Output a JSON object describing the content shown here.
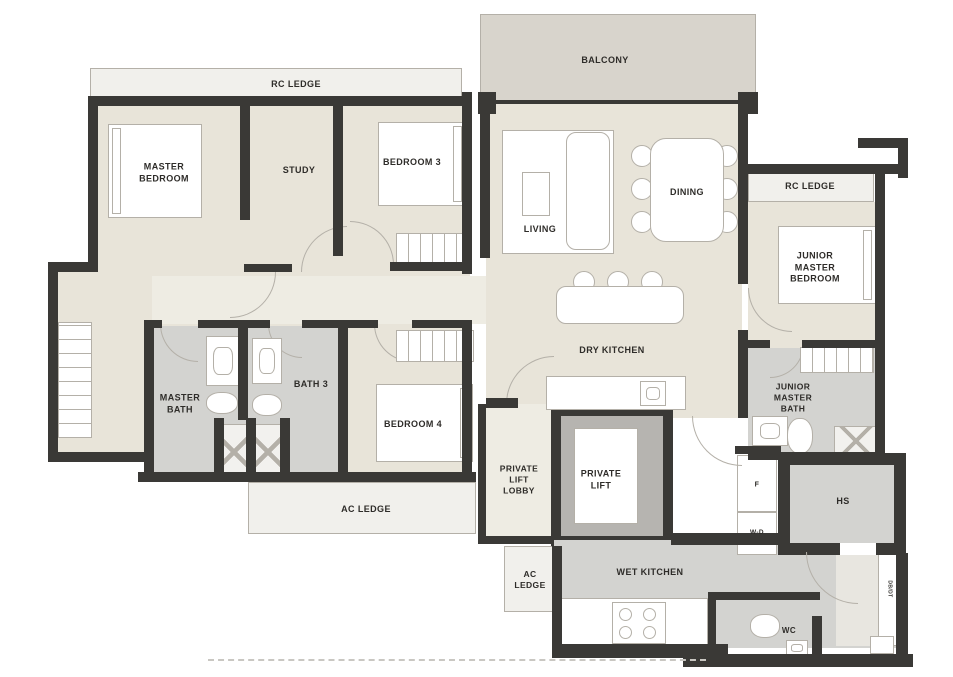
{
  "title": "Residential Unit Floor Plan",
  "colors": {
    "wall": "#3a3936",
    "beige": "#e8e4d9",
    "cream": "#eeece3",
    "grey": "#d3d3d0",
    "balcony": "#d8d4cc",
    "ledge": "#f1f0ec",
    "liftgrey": "#b6b4b0",
    "white": "#ffffff",
    "lightzone": "#e8e6e0",
    "line": "#b4b0a8",
    "text": "#2e2c29"
  },
  "labels": [
    {
      "name": "rc-ledge-top-label",
      "text": "RC LEDGE",
      "x": 296,
      "y": 85,
      "s": 9
    },
    {
      "name": "balcony-label",
      "text": "BALCONY",
      "x": 605,
      "y": 61,
      "s": 9
    },
    {
      "name": "master-bedroom-label",
      "text": "MASTER\nBEDROOM",
      "x": 164,
      "y": 173,
      "s": 9
    },
    {
      "name": "study-label",
      "text": "STUDY",
      "x": 299,
      "y": 171,
      "s": 9
    },
    {
      "name": "bedroom-3-label",
      "text": "BEDROOM 3",
      "x": 412,
      "y": 163,
      "s": 9
    },
    {
      "name": "living-label",
      "text": "LIVING",
      "x": 540,
      "y": 230,
      "s": 9
    },
    {
      "name": "dining-label",
      "text": "DINING",
      "x": 687,
      "y": 193,
      "s": 9
    },
    {
      "name": "rc-ledge-right-label",
      "text": "RC LEDGE",
      "x": 810,
      "y": 187,
      "s": 9
    },
    {
      "name": "junior-master-bedroom-label",
      "text": "JUNIOR\nMASTER\nBEDROOM",
      "x": 815,
      "y": 268,
      "s": 9
    },
    {
      "name": "dry-kitchen-label",
      "text": "DRY KITCHEN",
      "x": 612,
      "y": 351,
      "s": 9
    },
    {
      "name": "master-bath-label",
      "text": "MASTER\nBATH",
      "x": 180,
      "y": 404,
      "s": 9
    },
    {
      "name": "bath-3-label",
      "text": "BATH 3",
      "x": 311,
      "y": 385,
      "s": 9
    },
    {
      "name": "bedroom-4-label",
      "text": "BEDROOM 4",
      "x": 413,
      "y": 425,
      "s": 9
    },
    {
      "name": "ac-ledge-left-label",
      "text": "AC LEDGE",
      "x": 366,
      "y": 510,
      "s": 9
    },
    {
      "name": "private-lift-lobby-label",
      "text": "PRIVATE\nLIFT\nLOBBY",
      "x": 519,
      "y": 480,
      "s": 8.5
    },
    {
      "name": "private-lift-label",
      "text": "PRIVATE\nLIFT",
      "x": 601,
      "y": 480,
      "s": 9
    },
    {
      "name": "junior-master-bath-label",
      "text": "JUNIOR\nMASTER\nBATH",
      "x": 793,
      "y": 398,
      "s": 8.5
    },
    {
      "name": "fridge-label",
      "text": "F",
      "x": 757,
      "y": 485,
      "s": 7
    },
    {
      "name": "washer-dryer-label",
      "text": "W-D",
      "x": 757,
      "y": 533,
      "s": 6.5
    },
    {
      "name": "household-shelter-label",
      "text": "HS",
      "x": 843,
      "y": 502,
      "s": 9
    },
    {
      "name": "ac-ledge-small-label",
      "text": "AC\nLEDGE",
      "x": 530,
      "y": 580,
      "s": 8.5
    },
    {
      "name": "wet-kitchen-label",
      "text": "WET KITCHEN",
      "x": 650,
      "y": 573,
      "s": 9
    },
    {
      "name": "wc-label",
      "text": "WC",
      "x": 789,
      "y": 631,
      "s": 8
    },
    {
      "name": "db-dt-label",
      "text": "DB/DT",
      "x": 889,
      "y": 589,
      "s": 5,
      "rot": 90
    }
  ],
  "floors": [
    {
      "n": "rc-ledge-top",
      "x": 90,
      "y": 68,
      "w": 372,
      "h": 34,
      "f": "ledge",
      "br": true
    },
    {
      "n": "balcony",
      "x": 480,
      "y": 14,
      "w": 276,
      "h": 88,
      "f": "balcony",
      "br": true
    },
    {
      "n": "bedrooms-floor",
      "x": 92,
      "y": 103,
      "w": 378,
      "h": 230,
      "f": "beige"
    },
    {
      "n": "corridor",
      "x": 150,
      "y": 276,
      "w": 336,
      "h": 48,
      "f": "cream"
    },
    {
      "n": "walk-in-wardrobe-floor",
      "x": 52,
      "y": 266,
      "w": 100,
      "h": 196,
      "f": "beige"
    },
    {
      "n": "master-bath-floor",
      "x": 144,
      "y": 326,
      "w": 102,
      "h": 152,
      "f": "grey"
    },
    {
      "n": "bath-3-floor",
      "x": 246,
      "y": 326,
      "w": 98,
      "h": 152,
      "f": "grey"
    },
    {
      "n": "bedroom-4-floor",
      "x": 344,
      "y": 326,
      "w": 128,
      "h": 152,
      "f": "beige"
    },
    {
      "n": "ac-ledge-left",
      "x": 248,
      "y": 482,
      "w": 228,
      "h": 52,
      "f": "ledge",
      "br": true
    },
    {
      "n": "living-dining-floor",
      "x": 486,
      "y": 104,
      "w": 256,
      "h": 314,
      "f": "beige"
    },
    {
      "n": "rc-ledge-right",
      "x": 748,
      "y": 172,
      "w": 126,
      "h": 30,
      "f": "ledge",
      "br": true
    },
    {
      "n": "junior-master-bedroom-floor",
      "x": 748,
      "y": 202,
      "w": 127,
      "h": 146,
      "f": "beige"
    },
    {
      "n": "junior-master-bath-floor",
      "x": 748,
      "y": 348,
      "w": 127,
      "h": 110,
      "f": "grey"
    },
    {
      "n": "private-lift-lobby-floor",
      "x": 482,
      "y": 404,
      "w": 70,
      "h": 136,
      "f": "cream"
    },
    {
      "n": "private-lift-frame",
      "x": 551,
      "y": 406,
      "w": 122,
      "h": 140,
      "f": "wall"
    },
    {
      "n": "private-lift-inner",
      "x": 561,
      "y": 416,
      "w": 102,
      "h": 120,
      "f": "liftgrey"
    },
    {
      "n": "private-lift-cab",
      "x": 574,
      "y": 428,
      "w": 64,
      "h": 96,
      "f": "white",
      "br": true
    },
    {
      "n": "ac-ledge-small",
      "x": 504,
      "y": 546,
      "w": 52,
      "h": 66,
      "f": "ledge",
      "br": true
    },
    {
      "n": "wet-kitchen-floor",
      "x": 554,
      "y": 540,
      "w": 344,
      "h": 108,
      "f": "grey"
    },
    {
      "n": "entry-corridor",
      "x": 836,
      "y": 552,
      "w": 42,
      "h": 94,
      "f": "lightzone"
    },
    {
      "n": "db-dt-strip",
      "x": 878,
      "y": 548,
      "w": 20,
      "h": 98,
      "f": "white",
      "br": true
    },
    {
      "n": "fridge-box",
      "x": 737,
      "y": 455,
      "w": 40,
      "h": 57,
      "f": "white",
      "br": true
    },
    {
      "n": "washer-dryer-box",
      "x": 737,
      "y": 512,
      "w": 40,
      "h": 43,
      "f": "white",
      "br": true
    },
    {
      "n": "household-shelter-frame",
      "x": 778,
      "y": 453,
      "w": 128,
      "h": 102,
      "f": "wall"
    },
    {
      "n": "household-shelter-inner",
      "x": 790,
      "y": 465,
      "w": 104,
      "h": 78,
      "f": "grey"
    },
    {
      "n": "household-shelter-door-gap",
      "x": 840,
      "y": 543,
      "w": 36,
      "h": 12,
      "f": "white"
    },
    {
      "n": "wc-floor",
      "x": 716,
      "y": 600,
      "w": 96,
      "h": 48,
      "f": "grey"
    },
    {
      "n": "kitchen-counter",
      "x": 556,
      "y": 598,
      "w": 152,
      "h": 48,
      "f": "white",
      "br": true
    }
  ],
  "furniture": [
    {
      "n": "walkin-wardrobe",
      "k": "wardrobe-v",
      "x": 58,
      "y": 322,
      "w": 34,
      "h": 116
    },
    {
      "n": "master-bed",
      "k": "bed",
      "x": 108,
      "y": 124,
      "w": 94,
      "h": 94,
      "hb": "l"
    },
    {
      "n": "bedroom3-bed",
      "k": "bed",
      "x": 378,
      "y": 122,
      "w": 88,
      "h": 84,
      "hb": "r"
    },
    {
      "n": "bedroom3-cabinet",
      "k": "wardrobe-h",
      "x": 396,
      "y": 233,
      "w": 76,
      "h": 32
    },
    {
      "n": "bedroom4-wardrobe",
      "k": "wardrobe-h",
      "x": 396,
      "y": 330,
      "w": 78,
      "h": 32
    },
    {
      "n": "bedroom4-bed",
      "k": "bed",
      "x": 376,
      "y": 384,
      "w": 97,
      "h": 78,
      "hb": "r"
    },
    {
      "n": "junior-bed",
      "k": "bed",
      "x": 778,
      "y": 226,
      "w": 98,
      "h": 78,
      "hb": "r"
    },
    {
      "n": "junior-wardrobe",
      "k": "wardrobe-h",
      "x": 800,
      "y": 347,
      "w": 74,
      "h": 26
    },
    {
      "n": "living-rug",
      "k": "box",
      "x": 502,
      "y": 130,
      "w": 112,
      "h": 124
    },
    {
      "n": "tv-console",
      "k": "box",
      "x": 522,
      "y": 172,
      "w": 28,
      "h": 44
    },
    {
      "n": "sofa",
      "k": "round",
      "x": 566,
      "y": 132,
      "w": 44,
      "h": 118,
      "r": 10
    },
    {
      "n": "dining-chair",
      "k": "circle",
      "x": 631,
      "y": 145,
      "w": 22,
      "h": 22
    },
    {
      "n": "dining-chair",
      "k": "circle",
      "x": 631,
      "y": 178,
      "w": 22,
      "h": 22
    },
    {
      "n": "dining-chair",
      "k": "circle",
      "x": 631,
      "y": 211,
      "w": 22,
      "h": 22
    },
    {
      "n": "dining-chair",
      "k": "circle",
      "x": 716,
      "y": 145,
      "w": 22,
      "h": 22
    },
    {
      "n": "dining-chair",
      "k": "circle",
      "x": 716,
      "y": 178,
      "w": 22,
      "h": 22
    },
    {
      "n": "dining-chair",
      "k": "circle",
      "x": 716,
      "y": 211,
      "w": 22,
      "h": 22
    },
    {
      "n": "dining-table",
      "k": "round",
      "x": 650,
      "y": 138,
      "w": 74,
      "h": 104,
      "r": 16
    },
    {
      "n": "bar-stool",
      "k": "circle",
      "x": 573,
      "y": 271,
      "w": 22,
      "h": 22
    },
    {
      "n": "bar-stool",
      "k": "circle",
      "x": 607,
      "y": 271,
      "w": 22,
      "h": 22
    },
    {
      "n": "bar-stool",
      "k": "circle",
      "x": 641,
      "y": 271,
      "w": 22,
      "h": 22
    },
    {
      "n": "kitchen-island",
      "k": "round",
      "x": 556,
      "y": 286,
      "w": 128,
      "h": 38,
      "r": 10
    },
    {
      "n": "dry-kitchen-counter",
      "k": "box",
      "x": 546,
      "y": 376,
      "w": 140,
      "h": 34
    },
    {
      "n": "dry-kitchen-sink",
      "k": "sink",
      "x": 640,
      "y": 381,
      "w": 26,
      "h": 25
    },
    {
      "n": "master-bath-sink",
      "k": "sink",
      "x": 206,
      "y": 336,
      "w": 34,
      "h": 50
    },
    {
      "n": "master-bath-toilet",
      "k": "toilet",
      "x": 206,
      "y": 392,
      "w": 32,
      "h": 22
    },
    {
      "n": "master-shower",
      "k": "shower",
      "x": 220,
      "y": 424,
      "w": 28,
      "h": 56
    },
    {
      "n": "master-shower-2",
      "k": "shower",
      "x": 254,
      "y": 424,
      "w": 28,
      "h": 56
    },
    {
      "n": "bath3-sink",
      "k": "sink",
      "x": 252,
      "y": 338,
      "w": 30,
      "h": 46
    },
    {
      "n": "bath3-toilet",
      "k": "toilet",
      "x": 252,
      "y": 394,
      "w": 30,
      "h": 22
    },
    {
      "n": "junior-bath-sink",
      "k": "sink",
      "x": 752,
      "y": 416,
      "w": 36,
      "h": 30
    },
    {
      "n": "junior-bath-heater",
      "k": "toilet",
      "x": 787,
      "y": 418,
      "w": 26,
      "h": 36
    },
    {
      "n": "junior-shower",
      "k": "shower",
      "x": 834,
      "y": 426,
      "w": 44,
      "h": 30
    },
    {
      "n": "wc-toilet",
      "k": "toilet",
      "x": 750,
      "y": 614,
      "w": 30,
      "h": 24
    },
    {
      "n": "wc-sink",
      "k": "sink",
      "x": 786,
      "y": 640,
      "w": 22,
      "h": 16
    },
    {
      "n": "stove",
      "k": "stove",
      "x": 612,
      "y": 602,
      "w": 54,
      "h": 42
    },
    {
      "n": "corner-vent",
      "k": "box",
      "x": 870,
      "y": 636,
      "w": 24,
      "h": 18
    },
    {
      "n": "balcony-post-dot",
      "k": "box",
      "x": 483,
      "y": 97,
      "w": 8,
      "h": 8
    },
    {
      "n": "balcony-post-dot",
      "k": "box",
      "x": 745,
      "y": 97,
      "w": 8,
      "h": 8
    }
  ],
  "walls": [
    [
      88,
      96,
      384,
      10
    ],
    [
      88,
      96,
      10,
      176
    ],
    [
      48,
      262,
      50,
      10
    ],
    [
      48,
      262,
      10,
      200
    ],
    [
      48,
      452,
      104,
      10
    ],
    [
      144,
      320,
      10,
      162
    ],
    [
      138,
      472,
      212,
      10
    ],
    [
      344,
      472,
      132,
      10
    ],
    [
      240,
      96,
      10,
      124
    ],
    [
      333,
      96,
      10,
      160
    ],
    [
      244,
      264,
      48,
      8
    ],
    [
      390,
      262,
      82,
      9
    ],
    [
      462,
      92,
      10,
      182
    ],
    [
      462,
      324,
      10,
      158
    ],
    [
      144,
      320,
      18,
      8
    ],
    [
      198,
      320,
      50,
      8
    ],
    [
      246,
      320,
      24,
      8
    ],
    [
      302,
      320,
      44,
      8
    ],
    [
      344,
      320,
      34,
      8
    ],
    [
      412,
      320,
      60,
      8
    ],
    [
      238,
      328,
      10,
      92
    ],
    [
      214,
      418,
      10,
      64
    ],
    [
      246,
      418,
      10,
      64
    ],
    [
      280,
      418,
      10,
      64
    ],
    [
      338,
      324,
      10,
      150
    ],
    [
      480,
      100,
      276,
      4
    ],
    [
      480,
      104,
      10,
      154
    ],
    [
      478,
      92,
      18,
      22
    ],
    [
      740,
      92,
      18,
      22
    ],
    [
      738,
      92,
      10,
      192
    ],
    [
      738,
      330,
      10,
      88
    ],
    [
      748,
      164,
      150,
      10
    ],
    [
      875,
      174,
      10,
      174
    ],
    [
      858,
      138,
      50,
      10
    ],
    [
      898,
      140,
      10,
      38
    ],
    [
      748,
      340,
      22,
      8
    ],
    [
      802,
      340,
      80,
      8
    ],
    [
      875,
      348,
      10,
      112
    ],
    [
      748,
      452,
      134,
      8
    ],
    [
      735,
      446,
      46,
      8
    ],
    [
      486,
      398,
      32,
      10
    ],
    [
      478,
      404,
      8,
      140
    ],
    [
      478,
      536,
      76,
      8
    ],
    [
      552,
      546,
      10,
      100
    ],
    [
      552,
      644,
      176,
      14
    ],
    [
      671,
      533,
      107,
      12
    ],
    [
      683,
      654,
      230,
      13
    ],
    [
      896,
      553,
      12,
      104
    ],
    [
      708,
      592,
      8,
      74
    ],
    [
      708,
      592,
      112,
      8
    ],
    [
      812,
      616,
      10,
      44
    ]
  ],
  "arcs": [
    {
      "n": "master-bedroom-door",
      "x": 230,
      "y": 272,
      "s": 46,
      "c": "br"
    },
    {
      "n": "study-door",
      "x": 301,
      "y": 226,
      "s": 46,
      "c": "tl"
    },
    {
      "n": "bedroom3-door",
      "x": 350,
      "y": 221,
      "s": 44,
      "c": "tr"
    },
    {
      "n": "bedroom4-door",
      "x": 374,
      "y": 324,
      "s": 38,
      "c": "bl"
    },
    {
      "n": "master-bath-door",
      "x": 160,
      "y": 324,
      "s": 38,
      "c": "bl"
    },
    {
      "n": "bath3-door",
      "x": 268,
      "y": 324,
      "s": 34,
      "c": "bl"
    },
    {
      "n": "junior-bedroom-door",
      "x": 748,
      "y": 288,
      "s": 44,
      "c": "bl"
    },
    {
      "n": "junior-bath-door",
      "x": 770,
      "y": 344,
      "s": 34,
      "c": "br"
    },
    {
      "n": "lobby-door",
      "x": 506,
      "y": 356,
      "s": 48,
      "c": "tl"
    },
    {
      "n": "wet-kitchen-door",
      "x": 692,
      "y": 416,
      "s": 50,
      "c": "bl"
    },
    {
      "n": "entry-door",
      "x": 806,
      "y": 552,
      "s": 52,
      "c": "bl"
    }
  ],
  "extras": [
    {
      "n": "boundary-dashed-line",
      "k": "dash",
      "x": 208,
      "y": 659,
      "w": 498,
      "h": 0
    }
  ]
}
